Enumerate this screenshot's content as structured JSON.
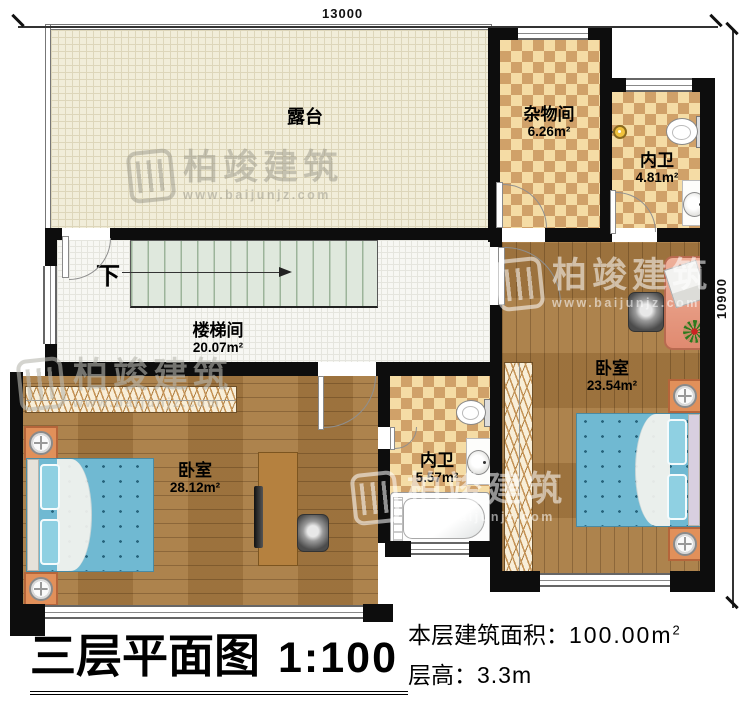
{
  "plan": {
    "dim_top": "13000",
    "dim_right": "10900",
    "stairs_down_label": "下",
    "rooms": {
      "terrace": {
        "name": "露台"
      },
      "storage": {
        "name": "杂物间",
        "area": "6.26m²"
      },
      "bath_top": {
        "name": "内卫",
        "area": "4.81m²"
      },
      "stairwell": {
        "name": "楼梯间",
        "area": "20.07m²"
      },
      "bedroom_left": {
        "name": "卧室",
        "area": "28.12m²"
      },
      "bath_mid": {
        "name": "内卫",
        "area": "5.57m²"
      },
      "bedroom_right": {
        "name": "卧室",
        "area": "23.54m²"
      }
    }
  },
  "titleblock": {
    "title": "三层平面图",
    "scale": "1:100",
    "area_label": "本层建筑面积：",
    "area_value": "100.00m",
    "area_exponent": "2",
    "floor_height_label": "层高：",
    "floor_height_value": "3.3m"
  },
  "watermark": {
    "brand": "柏竣建筑",
    "url": "www.baijunjz.com"
  },
  "colors": {
    "wall": "#0d0d0d",
    "terrace_floor": "#f1edd9",
    "tile_floor": "#f7f7f3",
    "checker_light": "#f5dca5",
    "checker_dark": "#d0a169",
    "wood_floor": "#a87b42",
    "stair_tread": "#dfe8dd",
    "bed_blue": "#70b9d2",
    "desk_salmon": "#e9a189",
    "nightstand_orange": "#e1905a"
  }
}
